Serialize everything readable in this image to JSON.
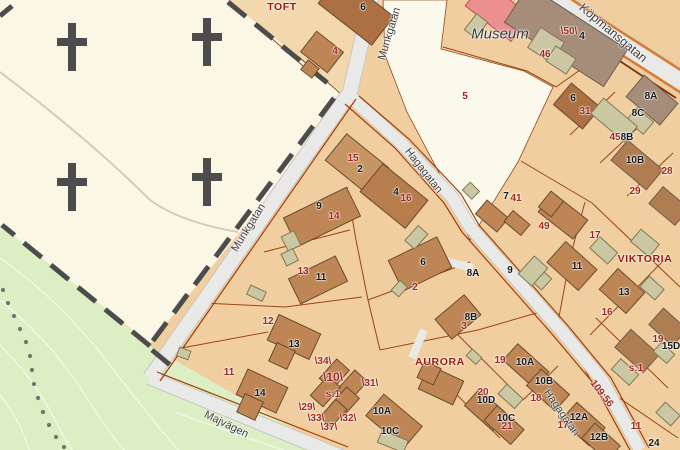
{
  "map": {
    "colors": {
      "parcel_tan": "#F1CE9F",
      "cemetery_cream": "#FAF7E5",
      "museum_grounds_cream": "#FBF9EC",
      "green_area": "#DBEEC4",
      "road_fill": "#E9EAE7",
      "main_road_stripe_orange": "#DC7A28",
      "boundary_red": "#9A4516",
      "road_edge_red": "#A83B02",
      "building_brown": "#BE8655",
      "building_taupe": "#A68D7A",
      "outbuilding_beige": "#CBC7A3",
      "museum_building_red": "#EC8F8F",
      "cross_gray": "#4C4C4C",
      "parcel_number_red": "#A1251B",
      "house_number_black": "#161616"
    },
    "streets": [
      "Munkgatan",
      "Munkgatan",
      "Hagagatan",
      "Hagagatan",
      "Majvägen",
      "Köpmansgatan"
    ],
    "places": [
      "TOFT",
      "AURORA",
      "VIKTORIA"
    ],
    "museum": "Museum",
    "red": [
      "4",
      "5",
      "\\50\\",
      "46",
      "31",
      "45",
      "28",
      "29",
      "15",
      "16",
      "14",
      "13",
      "2",
      "3",
      "41",
      "49",
      "17",
      "16",
      "19",
      "s:1",
      "109:56",
      "12",
      "11",
      "19",
      "20",
      "18",
      "21",
      "17",
      "11",
      "\\34\\",
      "\\10\\",
      "\\31\\",
      "s:1",
      "\\29\\",
      "\\33\\",
      "\\32\\",
      "\\37\\"
    ],
    "black": [
      "6",
      "4",
      "2",
      "4",
      "9",
      "11",
      "6",
      "7",
      "8A",
      "9",
      "8B",
      "6",
      "8A",
      "8C",
      "8B",
      "10B",
      "11",
      "13",
      "15D",
      "13",
      "14",
      "10A",
      "10C",
      "10A",
      "10B",
      "10D",
      "10C",
      "12A",
      "12B",
      "24"
    ]
  }
}
